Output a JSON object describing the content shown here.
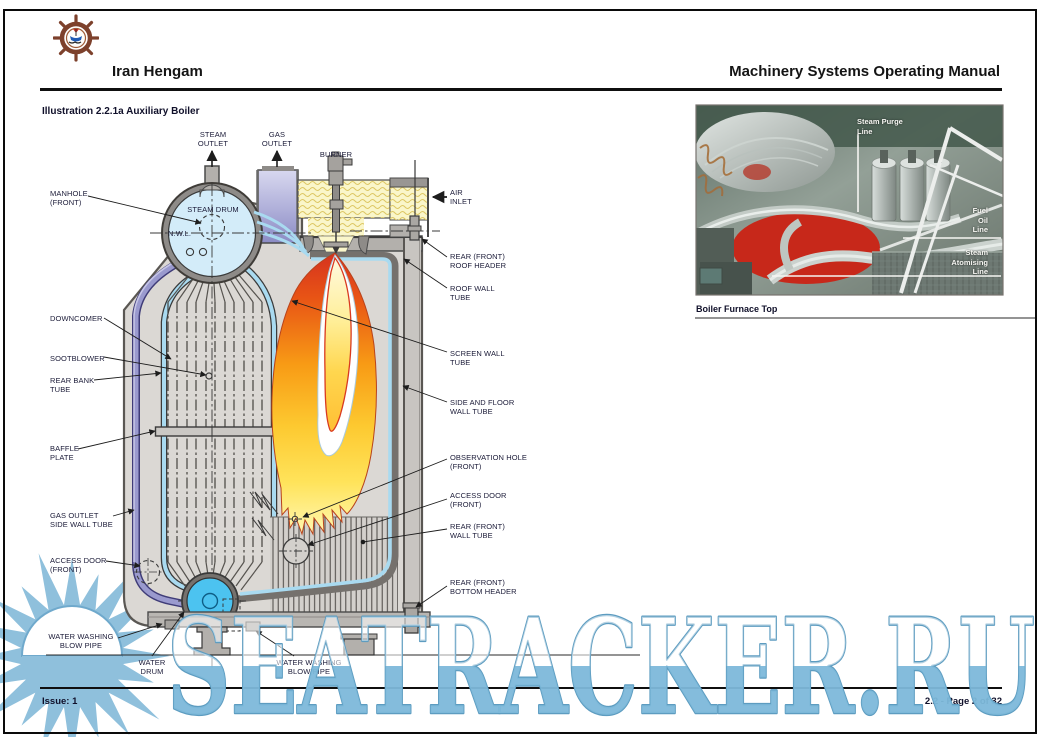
{
  "header": {
    "company": "Iran Hengam",
    "manual_title": "Machinery Systems Operating Manual"
  },
  "illustration_title": "Illustration 2.2.1a Auxiliary Boiler",
  "diagram": {
    "labels": {
      "steam_outlet": "STEAM\nOUTLET",
      "gas_outlet": "GAS\nOUTLET",
      "burner": "BURNER",
      "air_inlet": "AIR\nINLET",
      "manhole": "MANHOLE\n(FRONT)",
      "steam_drum": "STEAM DRUM",
      "nwl": "N.W.L.",
      "downcomer": "DOWNCOMER",
      "sootblower": "SOOTBLOWER",
      "rear_bank_tube": "REAR BANK\nTUBE",
      "baffle_plate": "BAFFLE\nPLATE",
      "gas_outlet_side_wall_tube": "GAS OUTLET\nSIDE WALL TUBE",
      "access_door_front_left": "ACCESS DOOR\n(FRONT)",
      "water_washing_blow_pipe_left": "WATER WASHING\nBLOW PIPE",
      "water_drum": "WATER\nDRUM",
      "water_washing_blow_pipe_right": "WATER WASHING\nBLOW PIPE",
      "rear_front_roof_header": "REAR (FRONT)\nROOF HEADER",
      "roof_wall_tube": "ROOF WALL\nTUBE",
      "screen_wall_tube": "SCREEN WALL\nTUBE",
      "side_and_floor_wall_tube": "SIDE AND FLOOR\nWALL TUBE",
      "observation_hole": "OBSERVATION HOLE\n(FRONT)",
      "access_door_front_right": "ACCESS DOOR\n(FRONT)",
      "rear_front_wall_tube": "REAR (FRONT)\nWALL TUBE",
      "rear_front_bottom_header": "REAR (FRONT)\nBOTTOM HEADER"
    }
  },
  "photo": {
    "caption": "Boiler Furnace Top",
    "labels": {
      "steam_purge": "Steam Purge\nLine",
      "fuel_oil": "Fuel\nOil\nLine",
      "steam_atomising": "Steam\nAtomising\nLine"
    }
  },
  "footer": {
    "issue": "Issue: 1",
    "page": "2.2 - Page 2 of 32"
  },
  "watermark": "SEATRACKER.RU",
  "colors": {
    "drum_blue": "#d3ecf9",
    "water_drum_blue": "#4cc3f0",
    "tube_blue": "#a9daf0",
    "wall_purple": "#9a9ace",
    "air_duct_yellow": "#faf6ca",
    "flame_red": "#d5321f",
    "flame_yellow": "#ffe35a",
    "watermark_blue": "#7db9da",
    "furnace_top_red": "#c7281a",
    "logo_brown": "#7d412c"
  }
}
